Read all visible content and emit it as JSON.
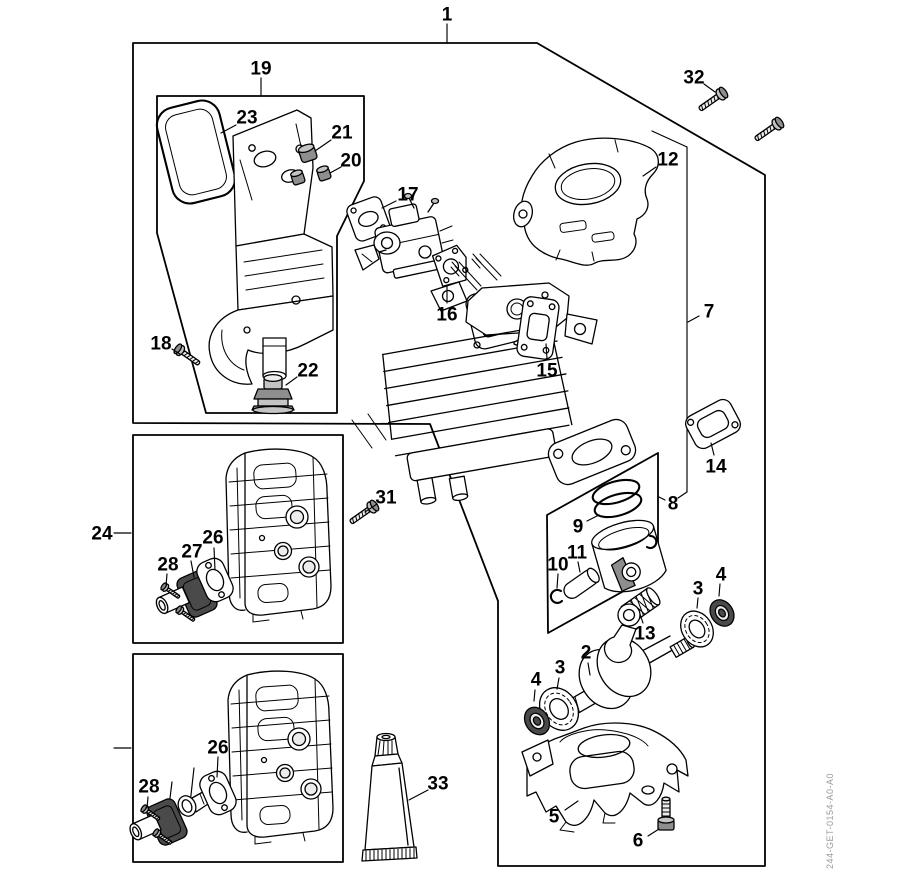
{
  "figure": {
    "type": "exploded-parts-diagram",
    "background": "#ffffff",
    "line_color": "#000000",
    "doc_number": "244-GET-0154-A0-A0"
  },
  "callouts": [
    {
      "text": "1",
      "x": 447,
      "y": 14,
      "leader": [
        [
          447,
          24
        ],
        [
          447,
          43
        ]
      ]
    },
    {
      "text": "19",
      "x": 261,
      "y": 68,
      "leader": [
        [
          261,
          78
        ],
        [
          261,
          95
        ]
      ]
    },
    {
      "text": "23",
      "x": 247,
      "y": 117,
      "leader": [
        [
          236,
          125
        ],
        [
          221,
          133
        ]
      ]
    },
    {
      "text": "21",
      "x": 342,
      "y": 132,
      "leader": [
        [
          331,
          140
        ],
        [
          315,
          151
        ]
      ]
    },
    {
      "text": "20",
      "x": 351,
      "y": 160,
      "leader": [
        [
          341,
          167
        ],
        [
          330,
          173
        ]
      ]
    },
    {
      "text": "17",
      "x": 408,
      "y": 194,
      "leader": [
        [
          396,
          201
        ],
        [
          382,
          208
        ]
      ]
    },
    {
      "text": "16",
      "x": 447,
      "y": 314,
      "leader": [
        [
          447,
          303
        ],
        [
          447,
          286
        ]
      ]
    },
    {
      "text": "15",
      "x": 547,
      "y": 370,
      "leader": [
        [
          547,
          359
        ],
        [
          546,
          344
        ]
      ]
    },
    {
      "text": "12",
      "x": 668,
      "y": 159,
      "leader": [
        [
          656,
          167
        ],
        [
          643,
          176
        ]
      ]
    },
    {
      "text": "7",
      "x": 709,
      "y": 311,
      "leader": [
        [
          699,
          316
        ],
        [
          688,
          322
        ]
      ]
    },
    {
      "text": "32",
      "x": 694,
      "y": 77,
      "leader": [
        [
          704,
          84
        ],
        [
          715,
          92
        ]
      ]
    },
    {
      "text": "14",
      "x": 716,
      "y": 466,
      "leader": [
        [
          714,
          455
        ],
        [
          711,
          443
        ]
      ]
    },
    {
      "text": "8",
      "x": 673,
      "y": 503,
      "leader": [
        [
          665,
          500
        ],
        [
          659,
          497
        ]
      ]
    },
    {
      "text": "9",
      "x": 578,
      "y": 526,
      "leader": [
        [
          587,
          521
        ],
        [
          599,
          515
        ]
      ]
    },
    {
      "text": "10",
      "x": 558,
      "y": 564,
      "leader": [
        [
          558,
          574
        ],
        [
          557,
          588
        ]
      ]
    },
    {
      "text": "11",
      "x": 577,
      "y": 552,
      "leader": [
        [
          578,
          562
        ],
        [
          580,
          572
        ]
      ]
    },
    {
      "text": "13",
      "x": 645,
      "y": 633,
      "leader": [
        [
          643,
          623
        ],
        [
          640,
          614
        ]
      ]
    },
    {
      "text": "2",
      "x": 586,
      "y": 652,
      "leader": [
        [
          588,
          663
        ],
        [
          590,
          675
        ]
      ]
    },
    {
      "text": "3",
      "x": 698,
      "y": 588,
      "leader": [
        [
          698,
          598
        ],
        [
          697,
          608
        ]
      ]
    },
    {
      "text": "4",
      "x": 721,
      "y": 574,
      "leader": [
        [
          720,
          584
        ],
        [
          719,
          596
        ]
      ]
    },
    {
      "text": "3",
      "x": 560,
      "y": 667,
      "leader": [
        [
          559,
          678
        ],
        [
          557,
          689
        ]
      ]
    },
    {
      "text": "4",
      "x": 536,
      "y": 679,
      "leader": [
        [
          535,
          690
        ],
        [
          534,
          701
        ]
      ]
    },
    {
      "text": "5",
      "x": 554,
      "y": 816,
      "leader": [
        [
          565,
          810
        ],
        [
          578,
          801
        ]
      ]
    },
    {
      "text": "6",
      "x": 638,
      "y": 840,
      "leader": [
        [
          648,
          836
        ],
        [
          659,
          829
        ]
      ]
    },
    {
      "text": "24",
      "x": 102,
      "y": 533,
      "leader": [
        [
          114,
          533
        ],
        [
          131,
          533
        ]
      ]
    },
    {
      "text": "31",
      "x": 386,
      "y": 497,
      "leader": [
        [
          377,
          504
        ],
        [
          365,
          512
        ]
      ]
    },
    {
      "text": "26",
      "x": 213,
      "y": 537,
      "leader": [
        [
          214,
          548
        ],
        [
          215,
          570
        ]
      ]
    },
    {
      "text": "27",
      "x": 192,
      "y": 551,
      "leader": [
        [
          191,
          561
        ],
        [
          194,
          577
        ]
      ]
    },
    {
      "text": "28",
      "x": 168,
      "y": 564,
      "leader": [
        [
          167,
          574
        ],
        [
          166,
          586
        ]
      ]
    },
    {
      "text": "22",
      "x": 308,
      "y": 370,
      "leader": [
        [
          297,
          377
        ],
        [
          286,
          385
        ]
      ]
    },
    {
      "text": "18",
      "x": 161,
      "y": 343,
      "leader": [
        [
          172,
          349
        ],
        [
          180,
          354
        ]
      ]
    },
    {
      "text": "33",
      "x": 438,
      "y": 783,
      "leader": [
        [
          428,
          790
        ],
        [
          409,
          800
        ]
      ]
    },
    {
      "text": "28",
      "x": 149,
      "y": 786,
      "leader": [
        [
          148,
          797
        ],
        [
          147,
          808
        ]
      ]
    },
    {
      "text": "26",
      "x": 218,
      "y": 747,
      "leader": [
        [
          218,
          757
        ],
        [
          217,
          777
        ]
      ]
    }
  ]
}
